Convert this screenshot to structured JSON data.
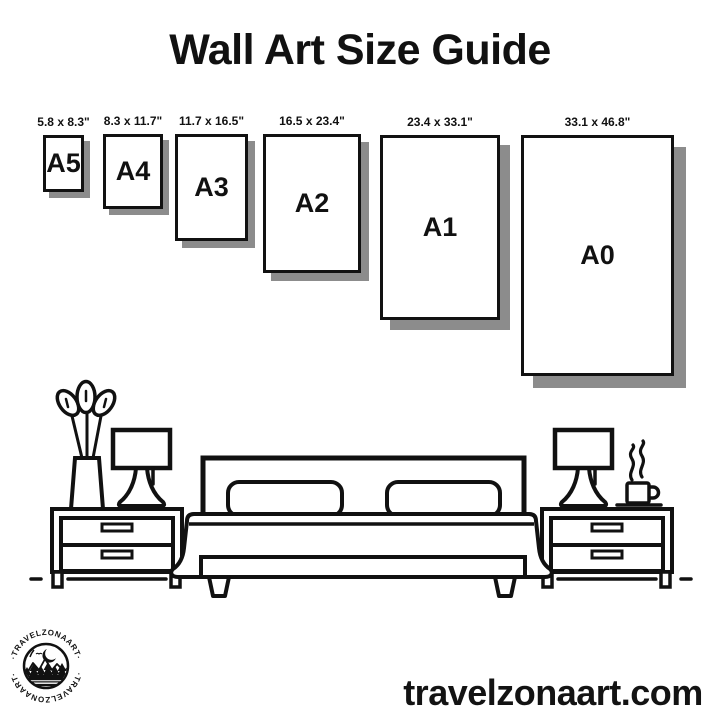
{
  "title": "Wall Art Size Guide",
  "size_guide": {
    "items": [
      {
        "name": "A5",
        "dimensions": "5.8 x 8.3\""
      },
      {
        "name": "A4",
        "dimensions": "8.3 x 11.7\""
      },
      {
        "name": "A3",
        "dimensions": "11.7 x 16.5\""
      },
      {
        "name": "A2",
        "dimensions": "16.5 x 23.4\""
      },
      {
        "name": "A1",
        "dimensions": "23.4 x 33.1\""
      },
      {
        "name": "A0",
        "dimensions": "33.1 x 46.8\""
      }
    ]
  },
  "illustration": {
    "icons": [
      "vase-plant-icon",
      "table-lamp-icon",
      "nightstand-icon",
      "bed-icon",
      "coffee-cup-steam-icon"
    ]
  },
  "branding": {
    "logo_arc_text_top": "·TRAVELZONAART·",
    "logo_arc_text_bottom": "·TRAVELZONAART·",
    "website": "travelzonaart.com"
  },
  "colors": {
    "ink": "#111111",
    "shadow": "#8c8c8c",
    "background": "#ffffff"
  }
}
